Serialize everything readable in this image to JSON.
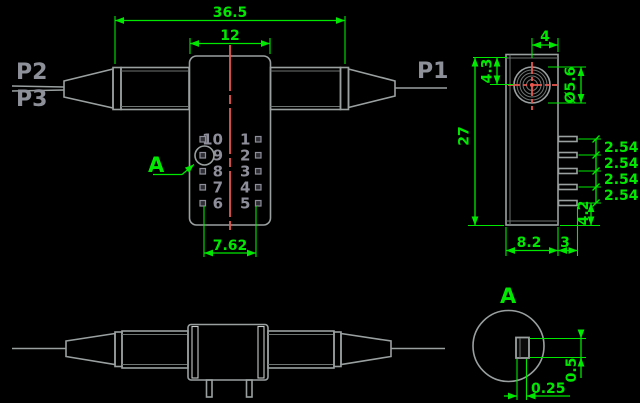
{
  "meta": {
    "drawing_type": "mechanical outline drawing",
    "component": "fiber optic switch package"
  },
  "colors": {
    "background": "#000000",
    "outline": "#9aa0a0",
    "dimension_green": "#00e800",
    "centerline_red": "#e8574d",
    "secondary_text": "#8e8e9a"
  },
  "ports": {
    "p1": "P1",
    "p2": "P2",
    "p3": "P3"
  },
  "top_view": {
    "dim_overall_length": "36.5",
    "dim_block_width": "12",
    "dim_pin_span": "7.62",
    "pins_left": [
      "10",
      "9",
      "8",
      "7",
      "6"
    ],
    "pins_right": [
      "1",
      "2",
      "3",
      "4",
      "5"
    ],
    "detail_label": "A"
  },
  "side_view": {
    "dim_lens_offset_x": "4",
    "dim_lens_offset_y": "4.3",
    "dim_lens_diameter": "Ø5.6",
    "dim_height": "27",
    "dim_pin_pitch": [
      "2.54",
      "2.54",
      "2.54",
      "2.54"
    ],
    "dim_body_depth": "8.2",
    "dim_pin_length": "3",
    "dim_pin_bottom_offset": "4.2"
  },
  "detail_view": {
    "label": "A",
    "dim_pin_thickness": "0.25",
    "dim_pin_width": "0.5"
  }
}
